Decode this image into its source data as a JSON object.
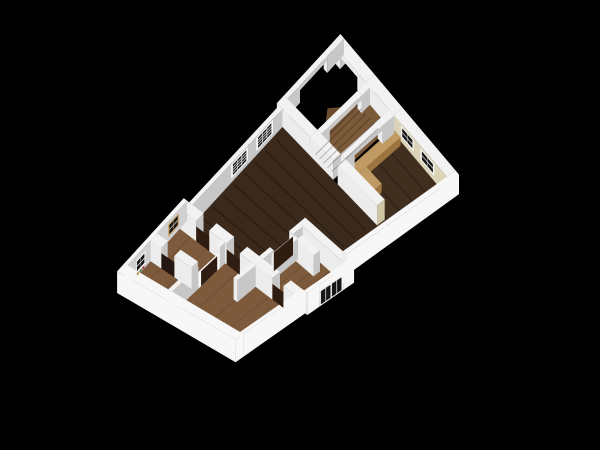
{
  "scene": {
    "background": "#000000",
    "wall_height_px": 18,
    "header_sill_px": 13
  },
  "palette": {
    "bg": "#000000",
    "wallTop": "#f2f2f2",
    "wallBright": "#ececec",
    "wallMid": "#c7c7c7",
    "wallDark": "#a9a9a9",
    "extWhite": "#f7f7f7",
    "intLight": "#d0d0d0",
    "cream": "#dbd4b8",
    "creamShade": "#cfc6a6",
    "floorLiving": "#3b2a1c",
    "floorKitchen": "#402f1f",
    "floorOak": "#7d5a3b",
    "floorHall": "#7b5a39",
    "stairWedge": "#6b4a2e",
    "doorDark": "#2f1d12",
    "doorwayShade": "#241610",
    "frameWhite": "#f8f8f8",
    "pane": "#161616",
    "tanFrame": "#c79e5e",
    "tanMuntin": "#f0e0c0",
    "counterTop": "#bf9a62",
    "counterSide": "#9c7440",
    "flower1": "#a83434",
    "flower2": "#3f7a34",
    "flower3": "#b5862e"
  },
  "projection": {
    "N": [
      342,
      62
    ],
    "E": [
      457,
      200
    ],
    "W": [
      133,
      290
    ],
    "S": [
      240,
      355
    ]
  },
  "floors": [
    {
      "name": "living-room-floor",
      "color": "floorLiving",
      "pts": [
        [
          0,
          0.285
        ],
        [
          0.84,
          0.285
        ],
        [
          0.84,
          0.25
        ],
        [
          0.95,
          0.25
        ],
        [
          0.95,
          0.5
        ],
        [
          0.61,
          0.5
        ],
        [
          0.61,
          0.715
        ],
        [
          0,
          0.715
        ]
      ],
      "streaks": {
        "dir": "a",
        "n": 8,
        "color": "rgba(0,0,0,0.25)",
        "sbox": [
          0.02,
          0.3,
          0.82,
          0.7
        ]
      }
    },
    {
      "name": "kitchen-floor",
      "color": "floorKitchen",
      "pts": [
        [
          0.49,
          0.02
        ],
        [
          0.95,
          0.02
        ],
        [
          0.95,
          0.285
        ],
        [
          0.49,
          0.285
        ]
      ],
      "streaks": {
        "dir": "a",
        "n": 4,
        "color": "rgba(0,0,0,0.22)",
        "sbox": [
          0.5,
          0.04,
          0.93,
          0.27
        ]
      }
    },
    {
      "name": "stair-hall-floor",
      "color": "floorHall",
      "pts": [
        [
          0.24,
          0.02
        ],
        [
          0.45,
          0.02
        ],
        [
          0.45,
          0.285
        ],
        [
          0.24,
          0.285
        ]
      ]
    },
    {
      "name": "porch-stair-wedge",
      "color": "stairWedge",
      "pts": [
        [
          0.24,
          0.05
        ],
        [
          0.24,
          0.22
        ],
        [
          0.12,
          0.135
        ]
      ]
    },
    {
      "name": "bedroom-floor",
      "color": "floorOak",
      "pts": [
        [
          0.61,
          0.5
        ],
        [
          1.02,
          0.5
        ],
        [
          1.02,
          0.715
        ],
        [
          0.61,
          0.715
        ]
      ],
      "streaks": {
        "dir": "b",
        "n": 5,
        "color": "rgba(0,0,0,0.15)",
        "sbox": [
          0.63,
          0.52,
          1.0,
          0.7
        ]
      }
    },
    {
      "name": "left-wing-floor",
      "color": "floorOak",
      "pts": [
        [
          -0.05,
          0.715
        ],
        [
          1.0,
          0.715
        ],
        [
          1.0,
          1.0
        ],
        [
          -0.05,
          1.0
        ]
      ],
      "streaks": {
        "dir": "b",
        "n": 7,
        "color": "rgba(0,0,0,0.15)",
        "sbox": [
          -0.03,
          0.73,
          0.98,
          0.98
        ]
      }
    }
  ],
  "prisms": [
    {
      "name": "porch-ne-wall-left",
      "box": [
        -0.05,
        -0.02,
        0.02,
        0.02
      ]
    },
    {
      "name": "porch-ne-header",
      "box": [
        0.02,
        -0.02,
        0.17,
        0.02
      ],
      "z0": 13
    },
    {
      "name": "porch-ne-wall-right",
      "box": [
        0.17,
        -0.02,
        0.245,
        0.02
      ]
    },
    {
      "name": "porch-nw-wall-top",
      "box": [
        -0.05,
        -0.02,
        -0.02,
        0.06
      ]
    },
    {
      "name": "porch-nw-header",
      "box": [
        -0.05,
        0.06,
        -0.02,
        0.19
      ],
      "z0": 13
    },
    {
      "name": "porch-nw-wall-bottom",
      "box": [
        -0.05,
        0.19,
        -0.02,
        0.25
      ]
    },
    {
      "name": "ne-wall-mid",
      "box": [
        0.245,
        -0.02,
        0.49,
        0.02
      ]
    },
    {
      "name": "kitchen-ne-wall",
      "box": [
        0.49,
        -0.02,
        0.95,
        0.02
      ],
      "sb": "cream"
    },
    {
      "name": "porch-se-wall-a",
      "box": [
        0.245,
        0.02,
        0.28,
        0.06
      ]
    },
    {
      "name": "porch-se-header",
      "box": [
        0.245,
        0.06,
        0.28,
        0.21
      ],
      "z0": 13
    },
    {
      "name": "porch-se-wall-b",
      "box": [
        0.245,
        0.21,
        0.28,
        0.25
      ]
    },
    {
      "name": "porch-sw-wall",
      "box": [
        -0.05,
        0.25,
        0.245,
        0.285
      ]
    },
    {
      "name": "hall-sw-wall",
      "box": [
        0.245,
        0.25,
        0.45,
        0.285
      ]
    },
    {
      "name": "nw-windowed-wall",
      "box": [
        -0.03,
        0.285,
        0,
        0.715
      ]
    },
    {
      "name": "kitchen-counter",
      "box": [
        0.5,
        0.03,
        0.565,
        0.26
      ],
      "h": 8,
      "top": "counterTop",
      "sa": "counterSide",
      "sb": "counterSide"
    },
    {
      "name": "kitchen-counter-return",
      "box": [
        0.565,
        0.19,
        0.7,
        0.26
      ],
      "h": 8,
      "top": "counterTop",
      "sa": "counterSide",
      "sb": "counterSide"
    },
    {
      "name": "stairs-door-wall-a",
      "box": [
        0.45,
        0.02,
        0.49,
        0.075
      ]
    },
    {
      "name": "stairs-door-header",
      "box": [
        0.45,
        0.075,
        0.49,
        0.205
      ],
      "z0": 13
    },
    {
      "name": "stairs-door-wall-b",
      "box": [
        0.45,
        0.205,
        0.49,
        0.25
      ]
    },
    {
      "name": "kitchen-sw-wall",
      "box": [
        0.49,
        0.25,
        0.84,
        0.285
      ],
      "sa": "creamShade"
    },
    {
      "name": "bedroom-ne-wall",
      "box": [
        0.61,
        0.5,
        1.02,
        0.53
      ]
    },
    {
      "name": "bedroom-nw-wall-a",
      "box": [
        0.61,
        0.53,
        0.645,
        0.575
      ]
    },
    {
      "name": "bedroom-nw-wall-b",
      "box": [
        0.61,
        0.665,
        0.645,
        0.715
      ]
    },
    {
      "name": "bedroom-hook-wall-a",
      "box": [
        0.69,
        0.555,
        0.85,
        0.585
      ]
    },
    {
      "name": "bedroom-hook-wall-b",
      "box": [
        0.655,
        0.575,
        0.69,
        0.68
      ]
    },
    {
      "name": "wing-l1-wall-a",
      "box": [
        -0.05,
        0.715,
        0.1,
        0.75
      ]
    },
    {
      "name": "wing-l1-wall-b",
      "box": [
        0.22,
        0.715,
        0.38,
        0.75
      ]
    },
    {
      "name": "wing-l1-wall-c",
      "box": [
        0.5,
        0.715,
        0.645,
        0.75
      ]
    },
    {
      "name": "bedroom-sw-wall-a",
      "box": [
        0.645,
        0.715,
        0.8,
        0.75
      ]
    },
    {
      "name": "bedroom-sw-wall-b",
      "box": [
        0.9,
        0.715,
        1.02,
        0.75
      ]
    },
    {
      "name": "wing-nw-ext-wall",
      "box": [
        -0.08,
        0.715,
        -0.05,
        1.0
      ],
      "sa": "intLight",
      "sb": "extWhite",
      "top": "extWhite"
    },
    {
      "name": "wing-l2-wall-a",
      "box": [
        0.33,
        0.75,
        0.365,
        0.775
      ]
    },
    {
      "name": "wing-l2-wall-b",
      "box": [
        0.33,
        0.875,
        0.365,
        1.0
      ]
    },
    {
      "name": "wing-stub-wall",
      "box": [
        0.61,
        0.75,
        0.645,
        0.835
      ]
    },
    {
      "name": "wing-l3-wall-a",
      "box": [
        -0.05,
        0.86,
        0.05,
        0.89
      ]
    },
    {
      "name": "wing-l3-wall-b",
      "box": [
        0.17,
        0.86,
        0.33,
        0.89
      ]
    },
    {
      "name": "kitchen-se-ext-wall",
      "box": [
        0.95,
        -0.02,
        0.98,
        0.31
      ],
      "sa": "extWhite",
      "top": "extWhite"
    },
    {
      "name": "se-step-ext-wall",
      "box": [
        0.95,
        0.31,
        0.98,
        0.5
      ],
      "sa": "extWhite",
      "top": "extWhite"
    },
    {
      "name": "bedroom-se-wall-a",
      "box": [
        1.02,
        0.5,
        1.05,
        0.55
      ],
      "sa": "extWhite",
      "top": "extWhite"
    },
    {
      "name": "bedroom-se-header",
      "box": [
        1.02,
        0.55,
        1.05,
        0.66
      ],
      "z0": 13,
      "sa": "extWhite",
      "top": "extWhite"
    },
    {
      "name": "bedroom-se-wall-b",
      "box": [
        1.02,
        0.66,
        1.05,
        0.715
      ],
      "sa": "extWhite",
      "top": "extWhite"
    },
    {
      "name": "wing-se-ext-wall",
      "box": [
        1.0,
        0.715,
        1.03,
        1.0
      ],
      "sa": "extWhite",
      "top": "extWhite"
    },
    {
      "name": "sw-ext-wall",
      "box": [
        -0.08,
        1.0,
        1.03,
        1.035
      ],
      "sa": "extWhite",
      "sb": "extWhite",
      "top": "extWhite"
    }
  ],
  "decals": [
    {
      "name": "stair-steps",
      "type": "steps",
      "sbox": [
        0.26,
        0.05,
        0.44,
        0.27
      ],
      "n": 5,
      "color": "rgba(0,0,0,0.20)"
    },
    {
      "name": "nw-grid-window-1",
      "type": "window",
      "p1": [
        0,
        0.33
      ],
      "p2": [
        0,
        0.41
      ],
      "z1": 4,
      "z2": 17,
      "cols": 3,
      "rows": 4,
      "frame": "frameWhite",
      "pane": "pane"
    },
    {
      "name": "nw-grid-window-2",
      "type": "window",
      "p1": [
        0,
        0.45
      ],
      "p2": [
        0,
        0.53
      ],
      "z1": 4,
      "z2": 17,
      "cols": 3,
      "rows": 4,
      "frame": "frameWhite",
      "pane": "pane"
    },
    {
      "name": "kitchen-window-1",
      "type": "window",
      "p1": [
        0.55,
        0.02
      ],
      "p2": [
        0.66,
        0.02
      ],
      "z1": 5,
      "z2": 16,
      "cols": 2,
      "rows": 2,
      "frame": "frameWhite",
      "pane": "pane"
    },
    {
      "name": "kitchen-window-2",
      "type": "window",
      "p1": [
        0.72,
        0.02
      ],
      "p2": [
        0.84,
        0.02
      ],
      "z1": 5,
      "z2": 16,
      "cols": 2,
      "rows": 2,
      "frame": "frameWhite",
      "pane": "pane"
    },
    {
      "name": "wing-door-1",
      "type": "door",
      "p1": [
        0.1,
        0.75
      ],
      "p2": [
        0.22,
        0.75
      ],
      "z1": 0,
      "z2": 13,
      "color": "doorDark"
    },
    {
      "name": "wing-door-2",
      "type": "door",
      "p1": [
        0.38,
        0.75
      ],
      "p2": [
        0.5,
        0.75
      ],
      "z1": 0,
      "z2": 13,
      "color": "doorDark"
    },
    {
      "name": "bedroom-nw-door",
      "type": "door",
      "p1": [
        0.645,
        0.575
      ],
      "p2": [
        0.645,
        0.665
      ],
      "z1": 0,
      "z2": 16,
      "color": "doorDark"
    },
    {
      "name": "bedroom-sw-door",
      "type": "door",
      "p1": [
        0.8,
        0.75
      ],
      "p2": [
        0.9,
        0.75
      ],
      "z1": 0,
      "z2": 13,
      "color": "doorDark"
    },
    {
      "name": "wing-l3-doorway",
      "type": "door",
      "p1": [
        0.05,
        0.89
      ],
      "p2": [
        0.17,
        0.89
      ],
      "z1": 0,
      "z2": 13,
      "color": "doorwayShade"
    },
    {
      "name": "wing-framed-door",
      "type": "framedDoor",
      "p1": [
        0.365,
        0.775
      ],
      "p2": [
        0.365,
        0.875
      ],
      "z1": 0,
      "z2": 14,
      "frame": "frameWhite",
      "inner": "doorDark"
    },
    {
      "name": "bedroom-french-door",
      "type": "french",
      "p1": [
        1.05,
        0.55
      ],
      "p2": [
        1.05,
        0.66
      ],
      "z1": 0,
      "z2": 13,
      "frame": "frameWhite",
      "pane": "pane"
    },
    {
      "name": "wing-tan-window",
      "type": "window",
      "p1": [
        -0.05,
        0.755
      ],
      "p2": [
        -0.05,
        0.805
      ],
      "z1": 4,
      "z2": 15,
      "cols": 2,
      "rows": 2,
      "frame": "tanFrame",
      "pane": "pane",
      "muntin": "tanMuntin"
    },
    {
      "name": "wing-flowerbox-window",
      "type": "flowerWindow",
      "p1": [
        -0.05,
        0.915
      ],
      "p2": [
        -0.05,
        0.96
      ],
      "z1": 3,
      "z2": 14,
      "cols": 2,
      "rows": 2,
      "frame": "frameWhite",
      "pane": "pane"
    }
  ]
}
